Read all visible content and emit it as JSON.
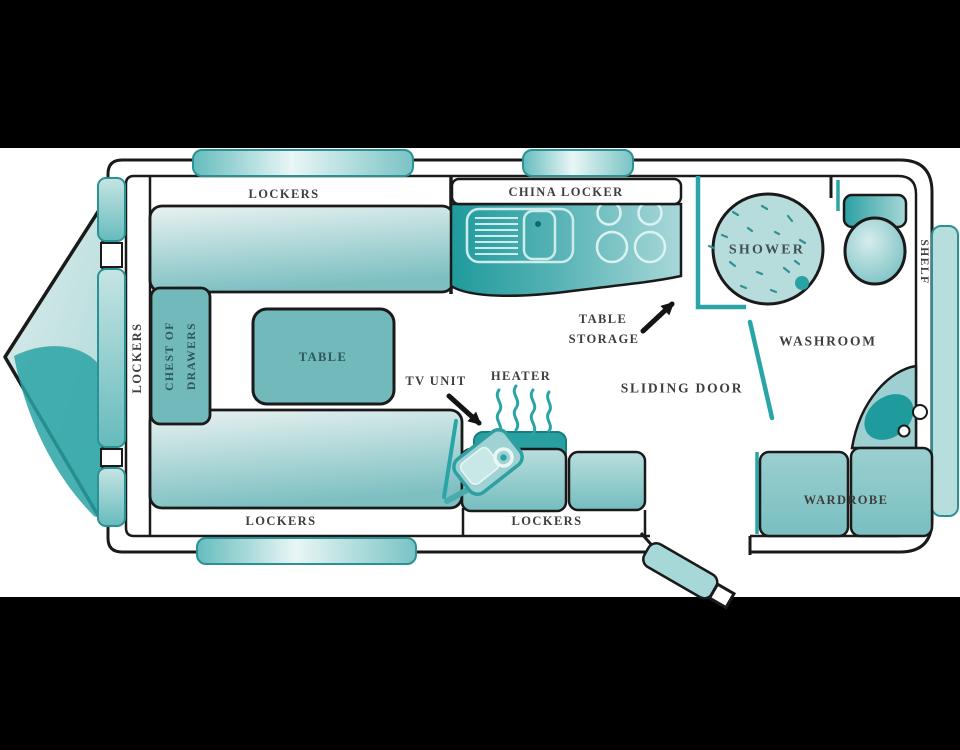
{
  "diagram": {
    "type": "caravan-floor-plan",
    "labels": {
      "lockers_top": "LOCKERS",
      "lockers_left": "LOCKERS",
      "lockers_bottom_left": "LOCKERS",
      "lockers_bottom_center": "LOCKERS",
      "china_locker": "CHINA LOCKER",
      "chest_of_drawers_line1": "CHEST OF",
      "chest_of_drawers_line2": "DRAWERS",
      "table": "TABLE",
      "tv_unit": "TV UNIT",
      "heater": "HEATER",
      "table_storage_line1": "TABLE",
      "table_storage_line2": "STORAGE",
      "sliding_door": "SLIDING DOOR",
      "washroom": "WASHROOM",
      "shower": "SHOWER",
      "shelf": "SHELF",
      "wardrobe": "WARDROBE"
    },
    "fixtures": [
      "drawbar-hitch",
      "front-windows",
      "sink",
      "hob-burners",
      "shower",
      "toilet",
      "corner-basin",
      "wardrobe",
      "tv",
      "heater",
      "entrance-door",
      "sliding-door",
      "dinette-seats",
      "table",
      "chest-of-drawers"
    ],
    "colors": {
      "letterbox": "#000000",
      "canvas": "#ffffff",
      "outline": "#1a1a1a",
      "teal_dark": "#28a0a2",
      "teal_medium": "#7fc0c2",
      "teal_light": "#bfe0e0",
      "label_text": "#3e3e3e"
    }
  }
}
